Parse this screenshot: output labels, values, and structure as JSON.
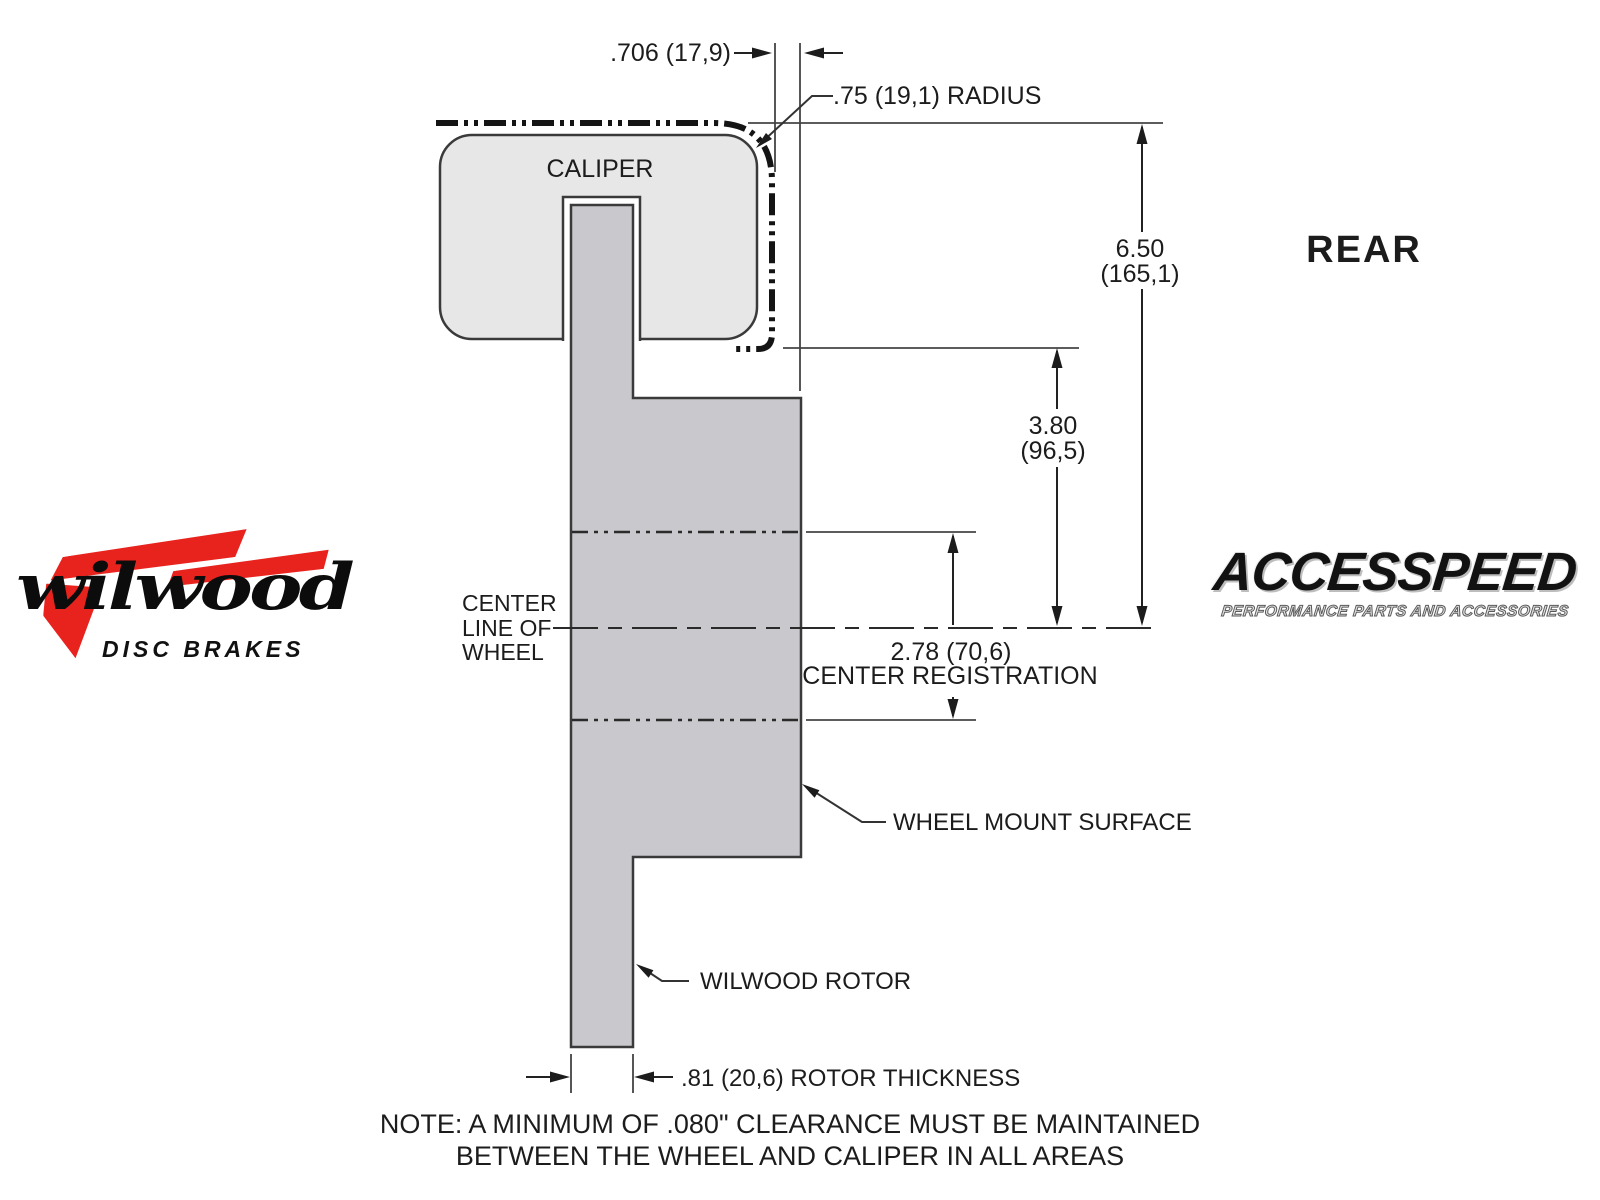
{
  "colors": {
    "caliper_fill": "#e7e7e7",
    "rotor_fill": "#c9c9cd",
    "outline": "#3a3a3a",
    "wilwood_red": "#e8231d"
  },
  "diagram": {
    "caliper_label": "CALIPER",
    "view_label": "REAR",
    "dims": {
      "caliper_offset": ".706 (17,9)",
      "radius": ".75 (19,1) RADIUS",
      "height_in": "6.50",
      "height_mm": "(165,1)",
      "drop_in": "3.80",
      "drop_mm": "(96,5)",
      "registration_value": "2.78 (70,6)",
      "registration_label": "CENTER REGISTRATION",
      "rotor_thickness": ".81 (20,6) ROTOR THICKNESS"
    },
    "callouts": {
      "centerline_line1": "CENTER",
      "centerline_line2": "LINE OF",
      "centerline_line3": "WHEEL",
      "wheel_mount": "WHEEL MOUNT SURFACE",
      "rotor": "WILWOOD ROTOR"
    },
    "note": {
      "line1": "NOTE: A MINIMUM OF .080\" CLEARANCE MUST BE MAINTAINED",
      "line2": "BETWEEN THE WHEEL AND CALIPER IN ALL AREAS"
    }
  },
  "logos": {
    "wilwood": {
      "wordmark": "wilwood",
      "tagline": "DISC BRAKES"
    },
    "accesspeed": {
      "wordmark": "ACCESSPEED",
      "tagline": "PERFORMANCE PARTS AND ACCESSORIES"
    }
  }
}
